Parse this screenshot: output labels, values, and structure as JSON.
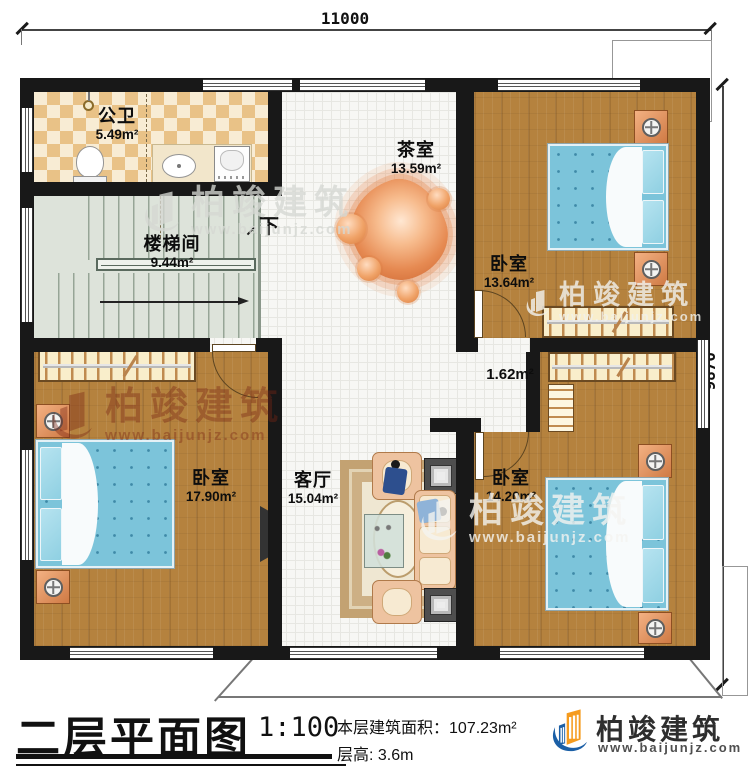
{
  "dimensions": {
    "width_top": "11000",
    "height_right": "9870"
  },
  "rooms": {
    "bathroom": {
      "name": "公卫",
      "area": "5.49m²"
    },
    "stairwell": {
      "name": "楼梯间",
      "area": "9.44m²",
      "direction": "下"
    },
    "tea_room": {
      "name": "茶室",
      "area": "13.59m²"
    },
    "bedroom_top": {
      "name": "卧室",
      "area": "13.64m²"
    },
    "hallway": {
      "area": "1.62m²"
    },
    "bedroom_left": {
      "name": "卧室",
      "area": "17.90m²"
    },
    "living_room": {
      "name": "客厅",
      "area": "15.04m²"
    },
    "bedroom_right": {
      "name": "卧室",
      "area": "14.20m²"
    }
  },
  "title_block": {
    "title": "二层平面图",
    "scale": "1:100",
    "area_label": "本层建筑面积：",
    "area_value": "107.23m²",
    "floor_height_label": "层高:",
    "floor_height_value": "3.6m"
  },
  "brand": {
    "name": "柏竣建筑",
    "website": "www.baijunjz.com"
  },
  "watermark": {
    "name": "柏竣建筑",
    "website": "www.baijunjz.com"
  },
  "colors": {
    "wall": "#181818",
    "wood_floor": "#b5823e",
    "bed_blue": "#7cc4da",
    "table_orange": "#e68a52",
    "logo_blue": "#1b5fa6",
    "logo_orange": "#f59b1e"
  }
}
